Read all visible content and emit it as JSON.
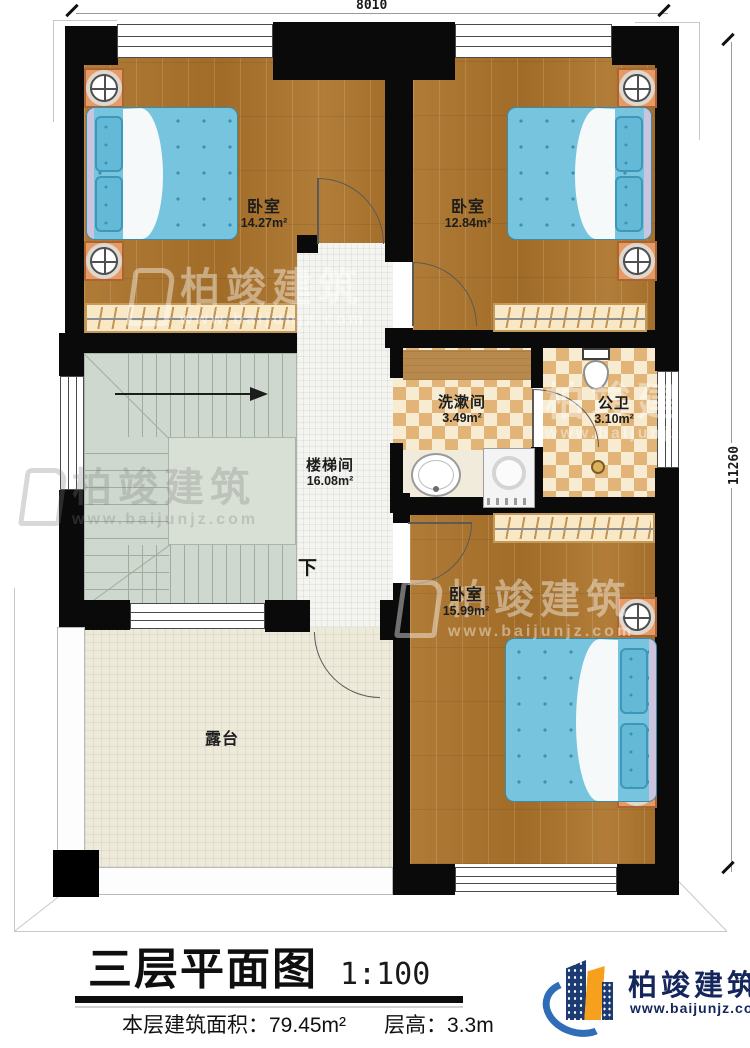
{
  "plan": {
    "dimensions": {
      "top": "8010",
      "right": "11260"
    },
    "rooms": {
      "bedroom1": {
        "name": "卧室",
        "area": "14.27m²"
      },
      "bedroom2": {
        "name": "卧室",
        "area": "12.84m²"
      },
      "washroom": {
        "name": "洗漱间",
        "area": "3.49m²"
      },
      "toilet": {
        "name": "公卫",
        "area": "3.10m²"
      },
      "stairwell": {
        "name": "楼梯间",
        "area": "16.08m²"
      },
      "bedroom3": {
        "name": "卧室",
        "area": "15.99m²"
      },
      "terrace": {
        "name": "露台"
      }
    },
    "stair_direction": "下"
  },
  "footer": {
    "title": "三层平面图",
    "scale": "1:100",
    "floor_area": "本层建筑面积：79.45m²",
    "floor_height": "层高：3.3m"
  },
  "brand": {
    "name": "柏竣建筑",
    "url": "www.baijunjz.com",
    "colors": {
      "navy": "#15265c",
      "blue": "#2f6db6",
      "orange": "#f6a01e"
    }
  },
  "watermark": {
    "text": "柏竣建筑",
    "url": "www.baijunjz.com"
  },
  "colors": {
    "wall": "#0a0a0a",
    "wood_floor": "#aa7530",
    "bed_blue": "#77c4de",
    "checker_tan": "#e2b477",
    "stair_green": "#cfd8ce",
    "terrace_beige": "#edeada"
  }
}
